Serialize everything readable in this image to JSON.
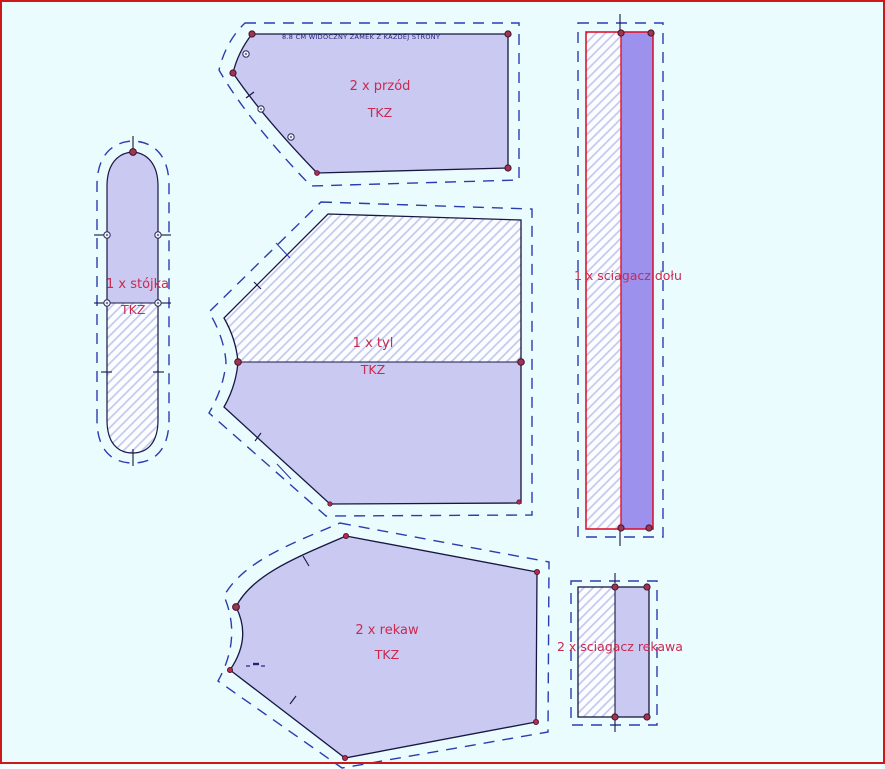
{
  "window": {
    "frame_color": "#cc1818",
    "background": "#eafcfd"
  },
  "colors": {
    "piece_fill": "#c9c9f1",
    "ribbing_fill": "#9c92ee",
    "hatch_line": "#bfc5ee",
    "hatch_background": "#fbfdff",
    "cut_line": "#171744",
    "seam_allowance_line": "#2b3cb0",
    "ribbing_outline": "#e1132e",
    "label_color": "#cb2950",
    "annotation_color": "#23237a",
    "point_marker": "#9b3653"
  },
  "pieces": [
    {
      "id": "front",
      "label": "2 x przód",
      "material": "TKZ",
      "note": "8.8 CM WIDOCZNY ZAMEK Z KAŻDEJ STRONY"
    },
    {
      "id": "collar-stand",
      "label": "1 x stójka",
      "material": "TKZ"
    },
    {
      "id": "back",
      "label": "1 x tyl",
      "material": "TKZ"
    },
    {
      "id": "sleeve",
      "label": "2 x rekaw",
      "material": "TKZ"
    },
    {
      "id": "hem-ribbing",
      "label": "1 x sciagacz dołu"
    },
    {
      "id": "sleeve-ribbing",
      "label": "2 x sciagacz rekawa"
    }
  ]
}
